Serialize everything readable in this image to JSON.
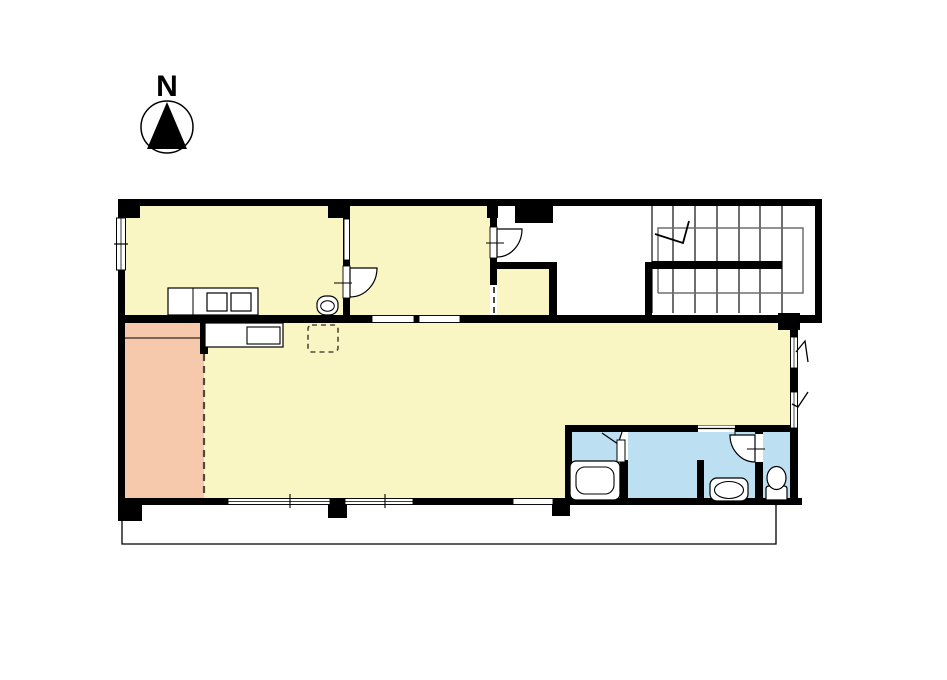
{
  "compass": {
    "label": "N"
  },
  "palette": {
    "background": "#FFFFFF",
    "wall": "#000000",
    "room_yellow": "#FAF6C4",
    "room_pink": "#F6C9AC",
    "room_blue": "#BCDFF2",
    "fixture_fill": "#FFFFFF",
    "stair_tread": "#4A4A4A",
    "stair_rail": "#6E6E6E",
    "dashed_line": "#4F4A3A"
  },
  "plan": {
    "type": "floor-plan",
    "rooms": [
      {
        "id": "top-left-room",
        "fill": "room_yellow"
      },
      {
        "id": "top-middle-room",
        "fill": "room_yellow"
      },
      {
        "id": "storage-alcove",
        "fill": "room_yellow"
      },
      {
        "id": "main-room",
        "fill": "room_yellow"
      },
      {
        "id": "bedroom-nook",
        "fill": "room_pink"
      },
      {
        "id": "bathroom-block",
        "fill": "room_blue"
      },
      {
        "id": "stair-hall",
        "fill": "background"
      }
    ],
    "fixtures": [
      "kitchen-counter",
      "stove-burners",
      "round-sink",
      "lower-counter",
      "dashed-floor-hatch",
      "bathtub",
      "washbasin",
      "toilet"
    ],
    "staircase": {
      "tread_lines": 7,
      "u_turn": true,
      "direction_arrow": true
    }
  }
}
